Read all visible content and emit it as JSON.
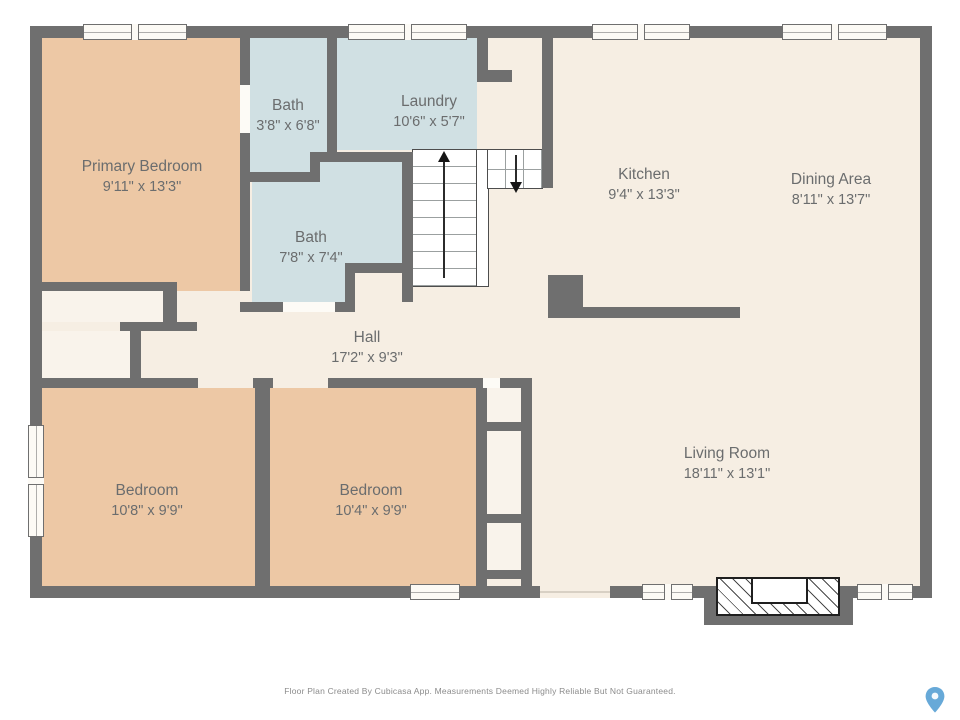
{
  "rooms": [
    {
      "key": "primary_bedroom",
      "name": "Primary Bedroom",
      "dims": "9'11\" x 13'3\""
    },
    {
      "key": "bath_small",
      "name": "Bath",
      "dims": "3'8\" x 6'8\""
    },
    {
      "key": "laundry",
      "name": "Laundry",
      "dims": "10'6\" x 5'7\""
    },
    {
      "key": "bath_main",
      "name": "Bath",
      "dims": "7'8\" x 7'4\""
    },
    {
      "key": "kitchen",
      "name": "Kitchen",
      "dims": "9'4\" x 13'3\""
    },
    {
      "key": "dining_area",
      "name": "Dining Area",
      "dims": "8'11\" x 13'7\""
    },
    {
      "key": "hall",
      "name": "Hall",
      "dims": "17'2\" x 9'3\""
    },
    {
      "key": "bedroom_left",
      "name": "Bedroom",
      "dims": "10'8\" x 9'9\""
    },
    {
      "key": "bedroom_middle",
      "name": "Bedroom",
      "dims": "10'4\" x 9'9\""
    },
    {
      "key": "living_room",
      "name": "Living Room",
      "dims": "18'11\" x 13'1\""
    }
  ],
  "footer": {
    "text": "Floor Plan Created By Cubicasa App. Measurements Deemed Highly Reliable But Not Guaranteed."
  },
  "colors": {
    "wall": "#6f6f6f",
    "floor": "#f6eee3",
    "bedroom_floor": "#edc8a5",
    "bath_floor": "#d0e0e3",
    "closet_floor": "#f9f3eb",
    "pin_accent": "#67a9d8",
    "label_text": "#6b6d6e"
  },
  "icons": {
    "pin": "location-pin-icon",
    "stairs_up": "stairs-up-arrow-icon",
    "stairs_down": "stairs-down-arrow-icon"
  }
}
